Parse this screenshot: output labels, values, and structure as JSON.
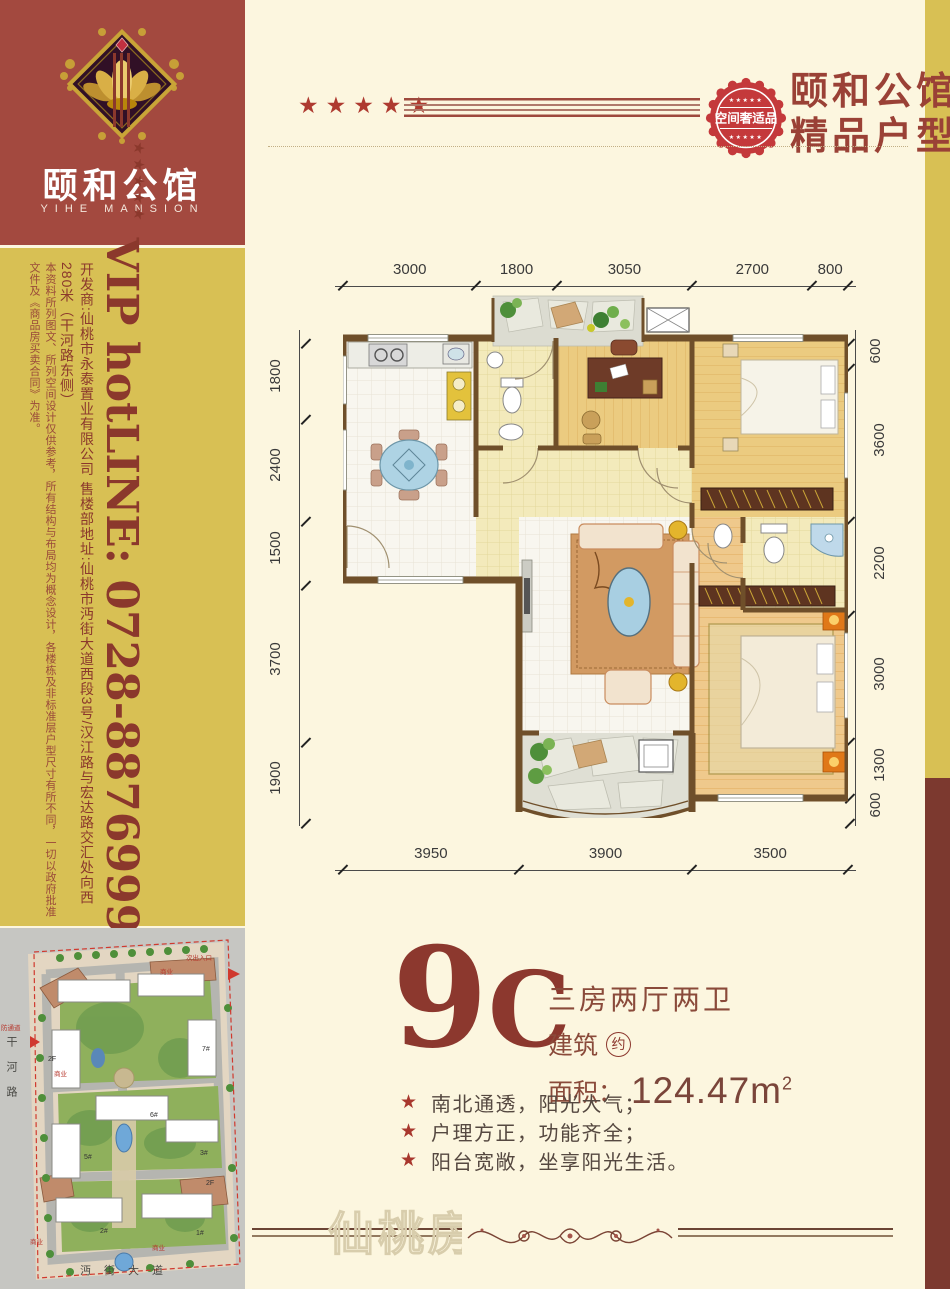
{
  "brand": {
    "logo_title": "颐和公馆",
    "logo_subtitle": "YIHE MANSION"
  },
  "header": {
    "stars": "★★★★★",
    "seal_text": "空间奢适品",
    "seal_stars": "★★★★★",
    "title_line1": "颐和公馆",
    "title_line2": "精品户型"
  },
  "sidebar": {
    "vip_line": "VIP hotLINE: 0728-8876999",
    "stars": "★★★★★",
    "developer_line": "开发商:仙桃市永泰置业有限公司  售楼部地址:仙桃市沔街大道西段3号/汉江路与宏达路交汇处向西280米（干河路东侧）",
    "disclaimer_line": "本资料所列图文、所列空间设计仅供参考，所有结构与布局均为概念设计，各楼栋及非标准层户型尺寸有所不同，一切以政府批准文件及《商品房买卖合同》为准。"
  },
  "floorplan": {
    "dims_top": [
      3000,
      1800,
      3050,
      2700,
      800
    ],
    "dims_left": [
      1800,
      2400,
      1500,
      3700,
      1900
    ],
    "dims_right": [
      600,
      3600,
      2200,
      3000,
      1300,
      600
    ],
    "dims_bottom": [
      3950,
      3900,
      3500
    ]
  },
  "unit": {
    "code_9": "9",
    "code_C": "C",
    "layout_type": "三房两厅两卫",
    "area_word1": "建筑",
    "area_approx": "约",
    "area_word2": "面积：",
    "area_value": "124.47m",
    "area_sup": "2"
  },
  "features_star": "★",
  "features": [
    {
      "text": "南北通透，阳光大气；"
    },
    {
      "text": "户理方正，功能齐全；"
    },
    {
      "text": "阳台宽敞，坐享阳光生活。"
    }
  ],
  "watermark": {
    "text": "仙桃房网"
  },
  "sitemap": {
    "road_left": "干河路",
    "road_bottom": "沔街大道",
    "entrance_label": "次出入口",
    "fire_lane": "防通道",
    "commerce_label": "商业",
    "floor_tag": "2F",
    "buildings": [
      "1#",
      "2#",
      "3#",
      "5#",
      "6#",
      "7#"
    ]
  },
  "colors": {
    "accent_red": "#9A4136",
    "gold": "#D8C054",
    "seal_red": "#C4393B",
    "maroon_block": "#A3493F",
    "strip_dark_red": "#7C392F",
    "wall_brown": "#6F4F2A",
    "cream_bg": "#FCF6DF"
  }
}
